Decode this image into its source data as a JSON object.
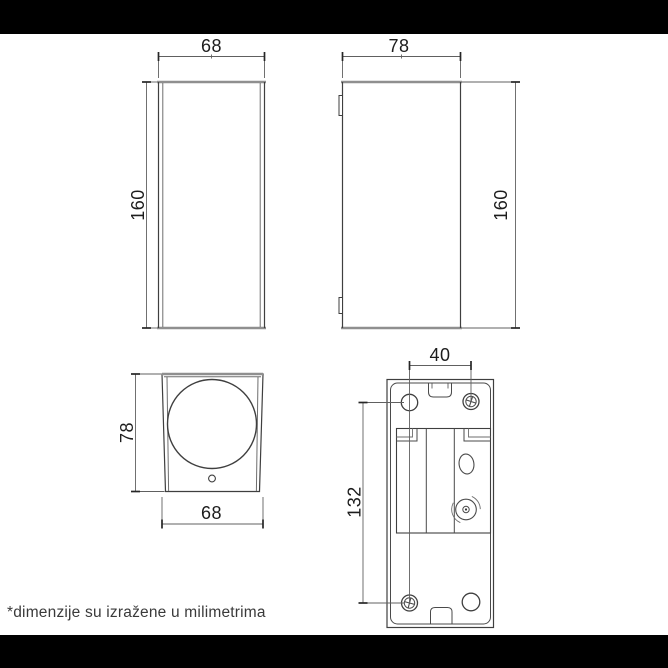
{
  "footnote": "*dimenzije su izražene u milimetrima",
  "front_view": {
    "width_mm": "68",
    "height_mm": "160"
  },
  "side_view": {
    "depth_mm": "78",
    "height_mm": "160"
  },
  "top_view": {
    "depth_mm": "78",
    "width_mm": "68"
  },
  "back_view": {
    "hole_spacing_width_mm": "40",
    "hole_spacing_height_mm": "132"
  },
  "colors": {
    "drawing_line": "#3f3f3f",
    "thick_edge": "#8f8f8f",
    "dimension_line": "#606060",
    "text": "#1d1d1d",
    "background": "#ffffff",
    "letterbox_bar": "#000000"
  }
}
